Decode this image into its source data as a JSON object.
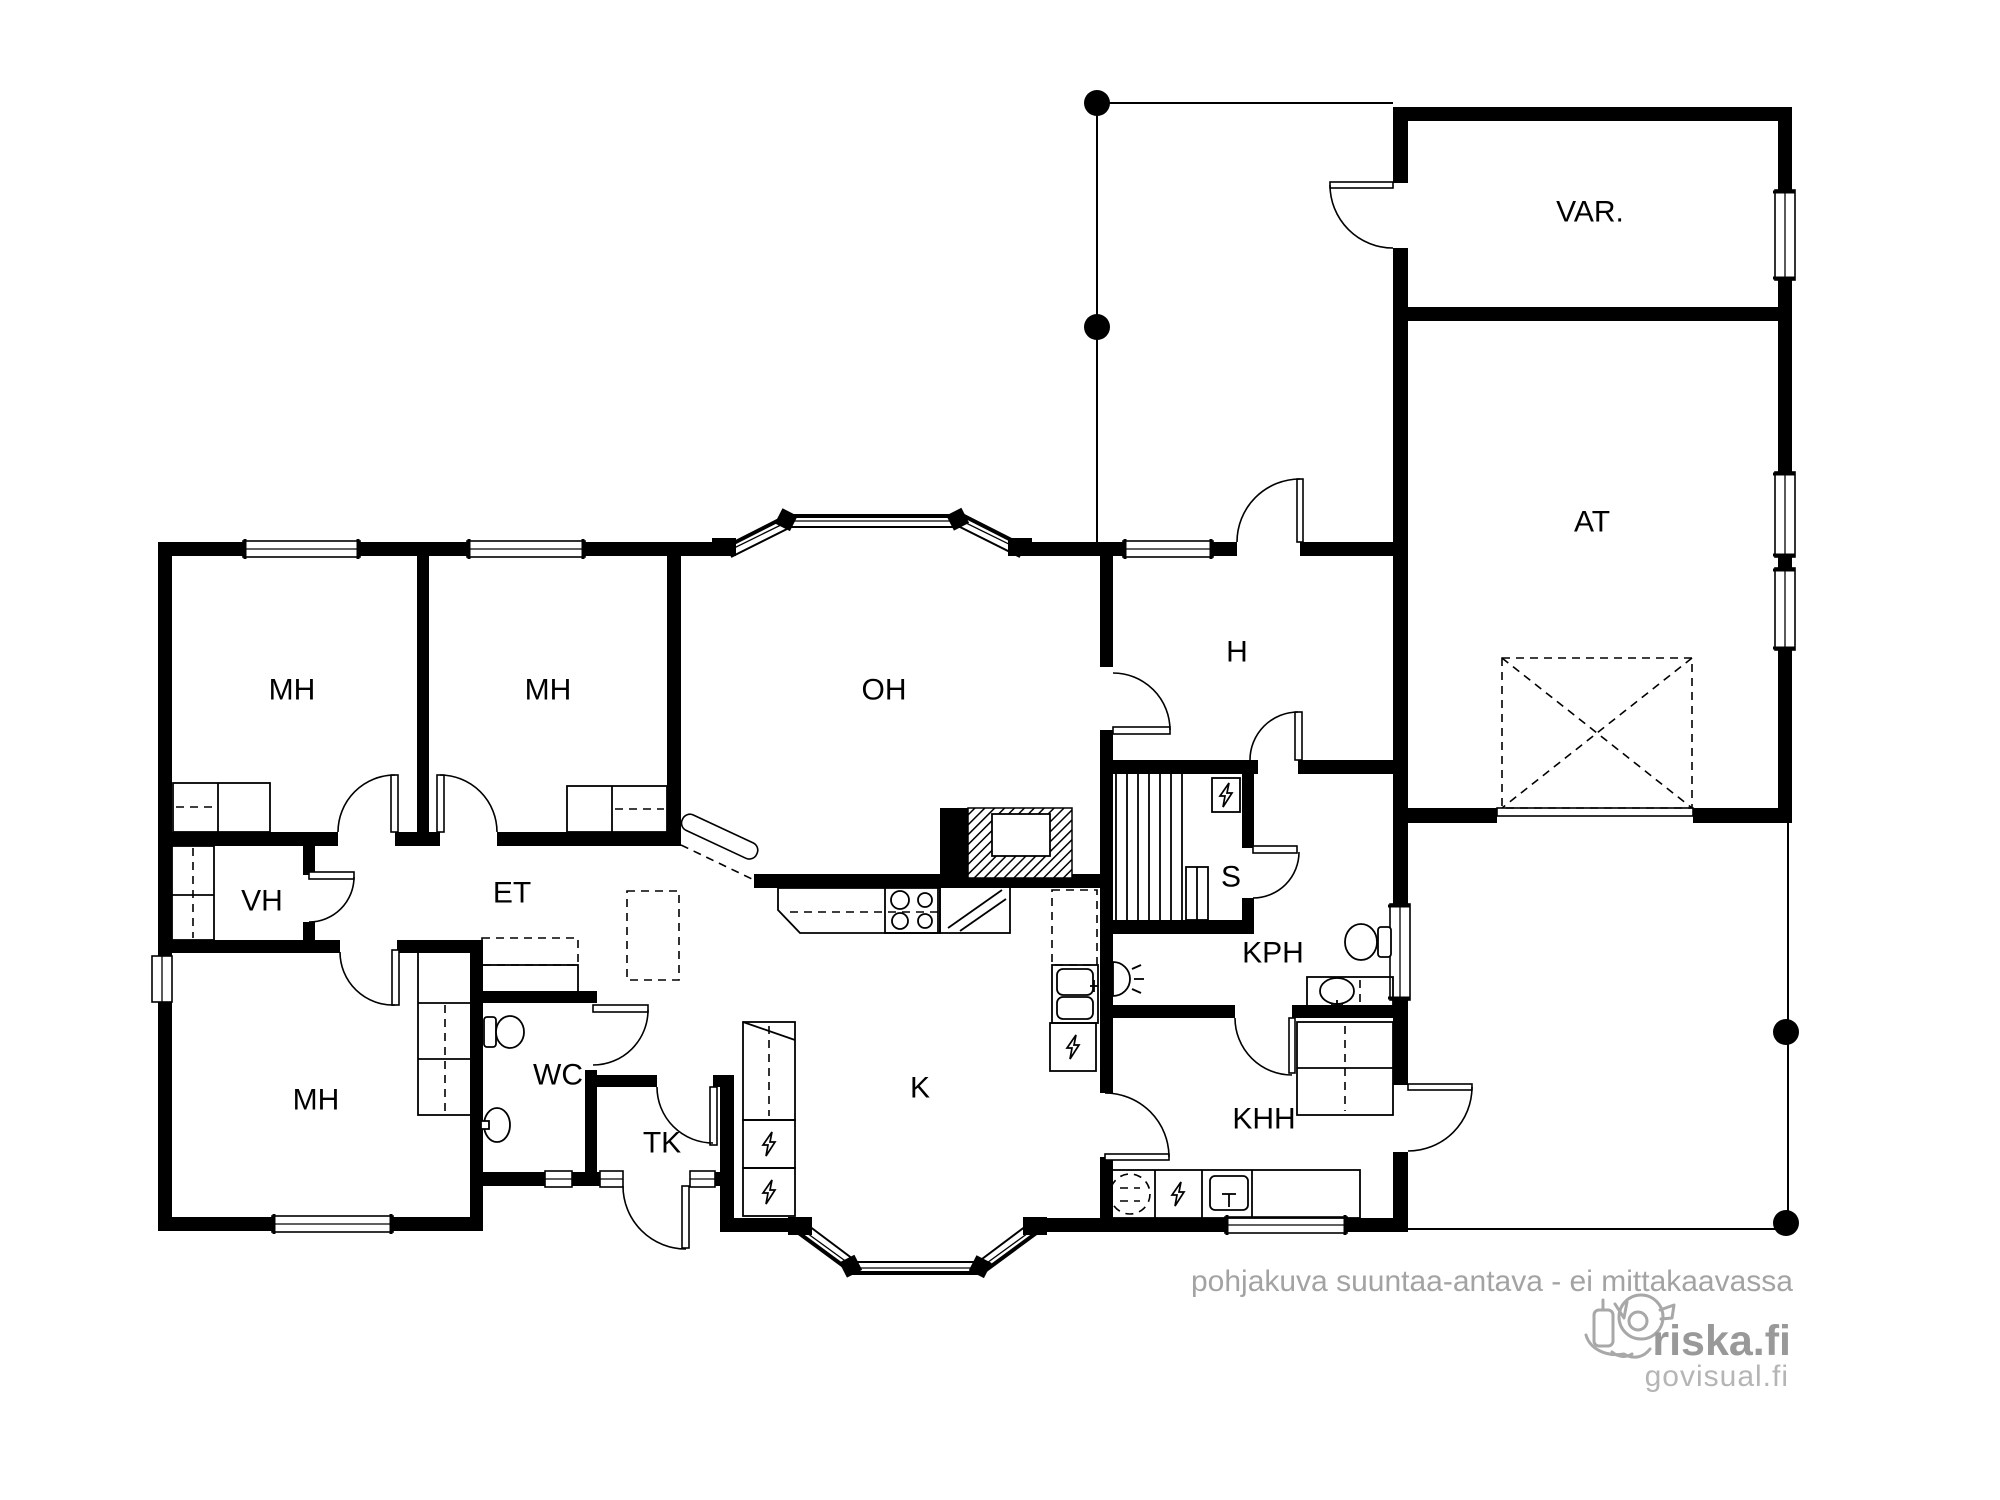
{
  "document": {
    "type": "floor-plan",
    "language": "fi"
  },
  "rooms": {
    "mh1": {
      "label": "MH"
    },
    "mh2": {
      "label": "MH"
    },
    "mh3": {
      "label": "MH"
    },
    "oh": {
      "label": "OH"
    },
    "h": {
      "label": "H"
    },
    "var": {
      "label": "VAR."
    },
    "at": {
      "label": "AT"
    },
    "vh": {
      "label": "VH"
    },
    "et": {
      "label": "ET"
    },
    "wc": {
      "label": "WC"
    },
    "tk": {
      "label": "TK"
    },
    "k": {
      "label": "K"
    },
    "s": {
      "label": "S"
    },
    "kph": {
      "label": "KPH"
    },
    "khh": {
      "label": "KHH"
    }
  },
  "watermark": {
    "disclaimer": "pohjakuva suuntaa-antava - ei mittakaavassa",
    "brand": "riska.fi",
    "sub_brand": "govisual.fi"
  },
  "colors": {
    "walls": "#000000",
    "background": "#ffffff",
    "watermark_text": "#a3a3a3",
    "brand_text": "#999999",
    "sub_brand_text": "#b5b5b5"
  },
  "icons": {
    "appliance": "lightning-bolt-square",
    "washing_machine": "dashed-circle",
    "stove": "four-burner-circles",
    "column_post": "filled-black-circle",
    "garage_reservation": "dashed-x-square"
  }
}
